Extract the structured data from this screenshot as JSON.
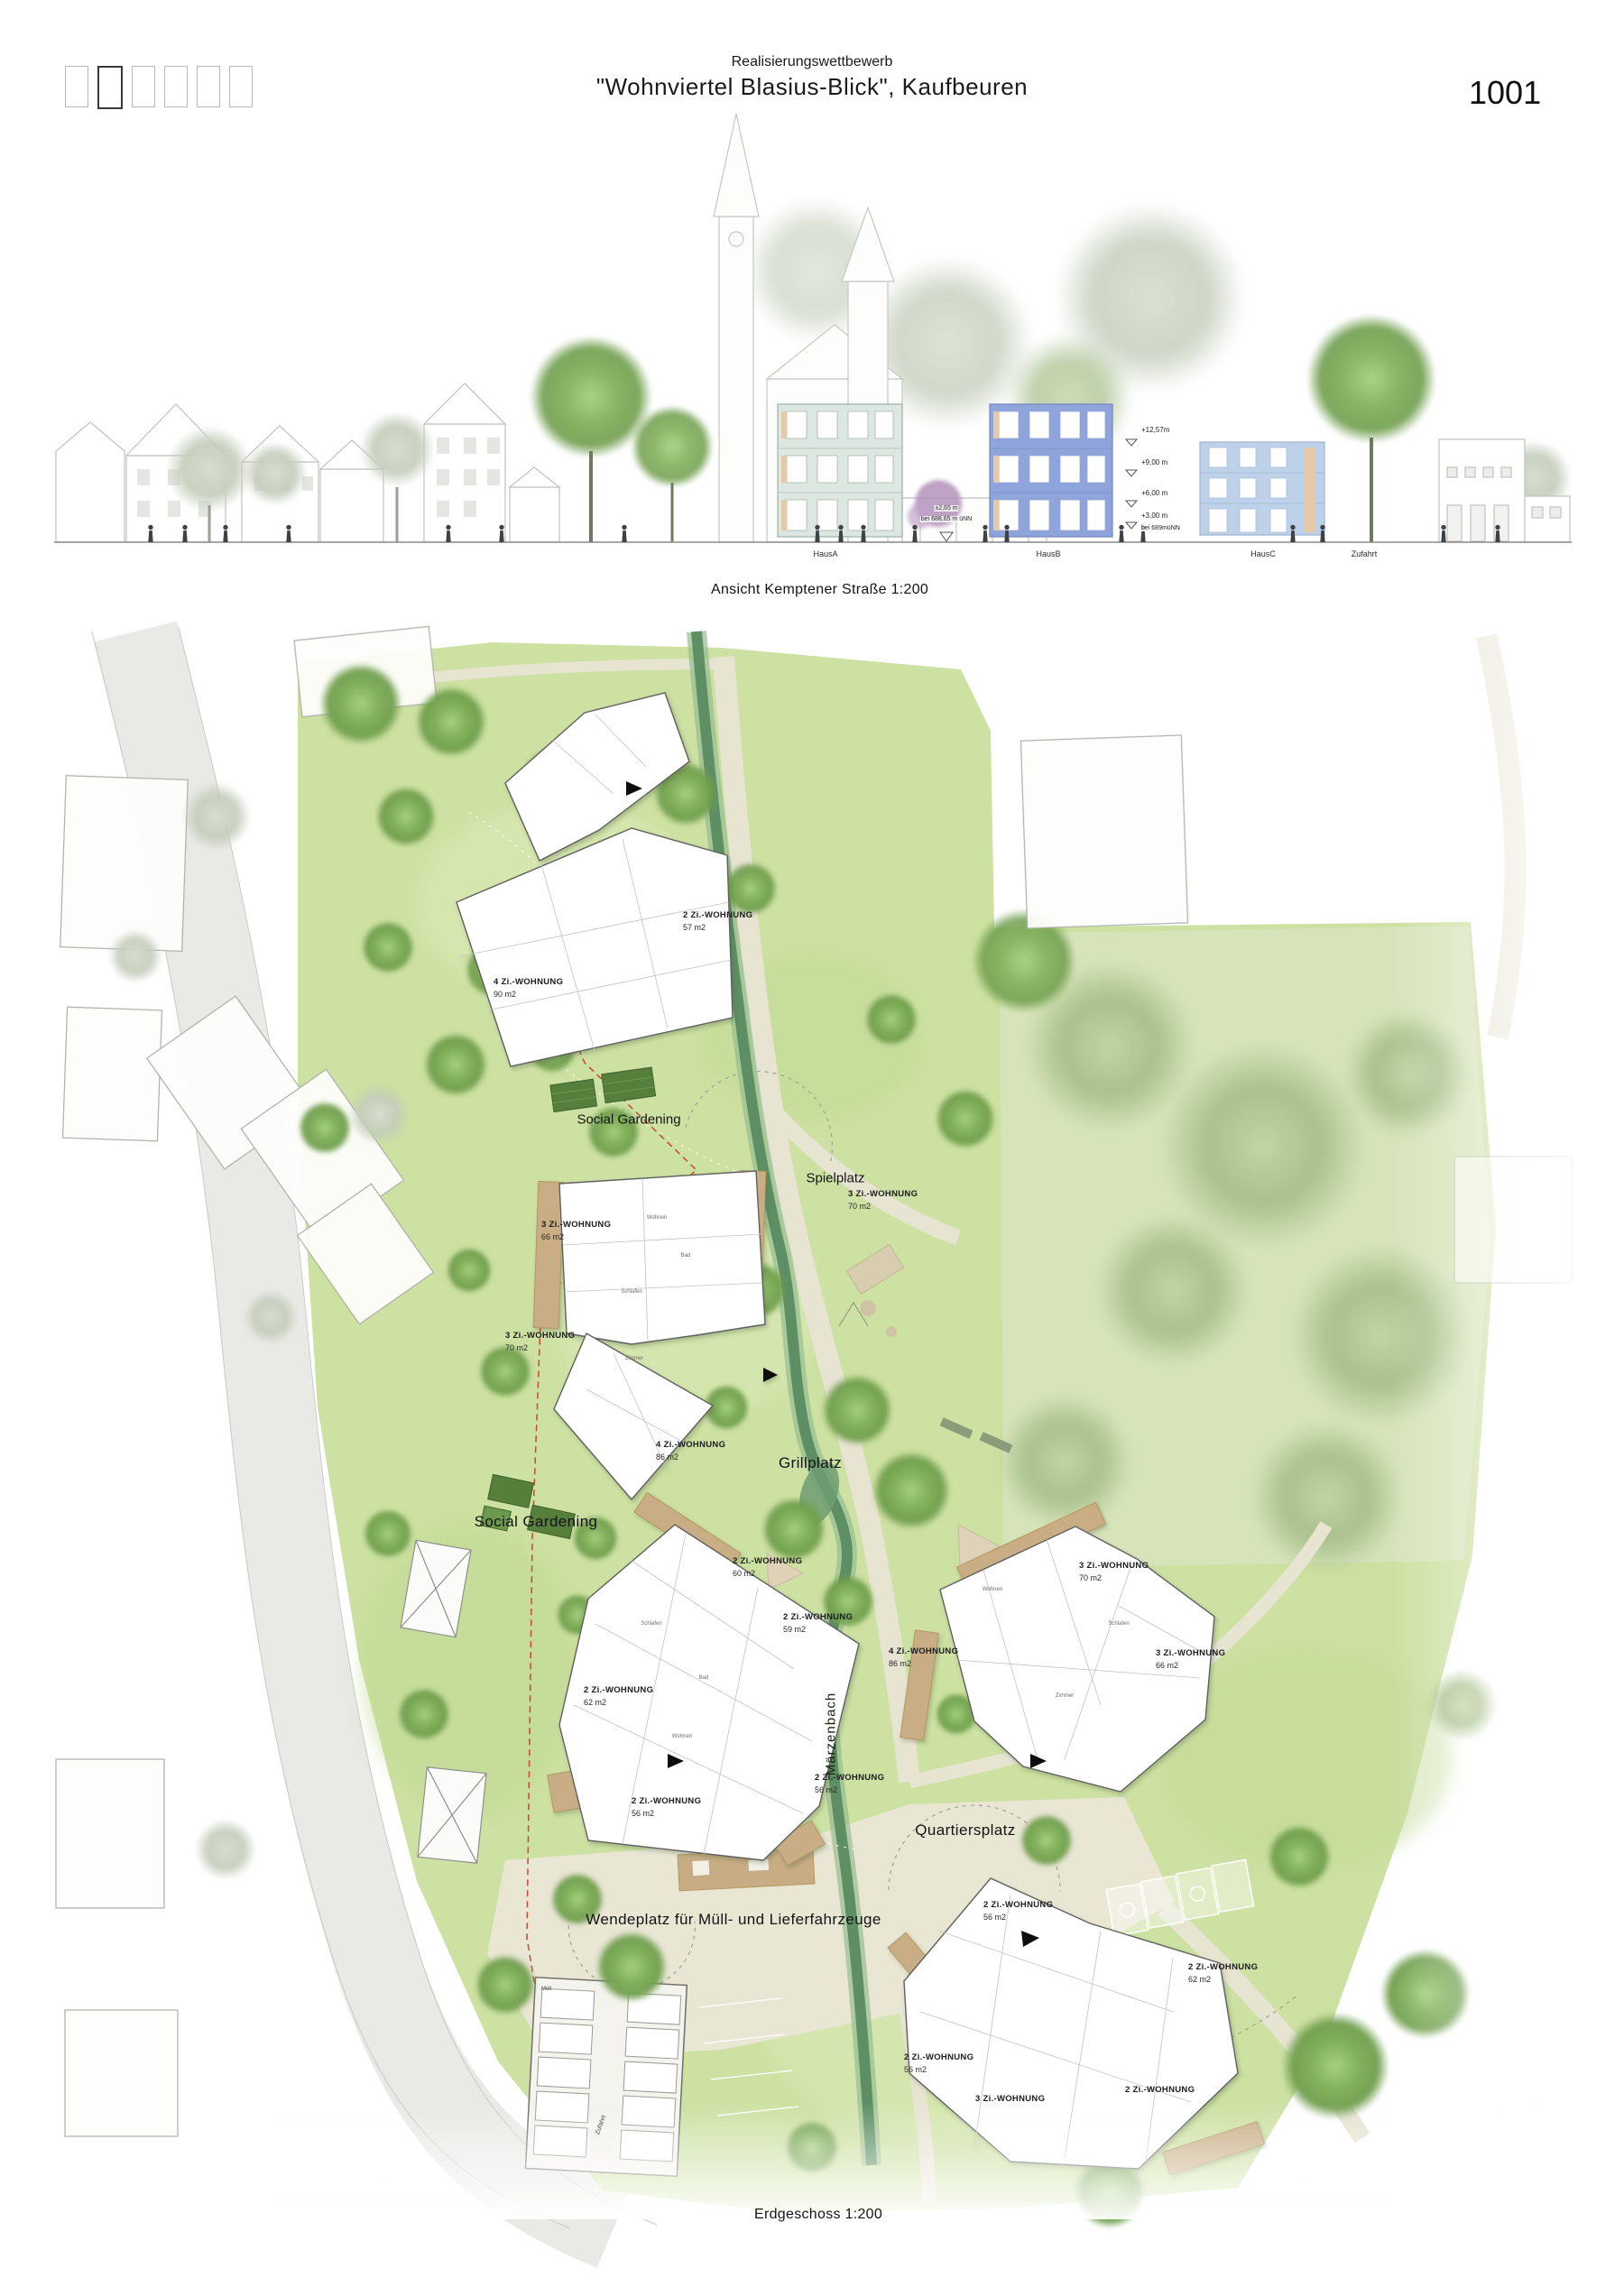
{
  "header": {
    "competition_line": "Realisierungswettbewerb",
    "project_title": "\"Wohnviertel Blasius-Blick\", Kaufbeuren",
    "board_number": "1001"
  },
  "elevation": {
    "caption": "Ansicht Kemptener Straße 1:200",
    "building_labels": [
      {
        "label": "HausA"
      },
      {
        "label": "HausB"
      },
      {
        "label": "HausC"
      },
      {
        "label": "Zufahrt"
      }
    ],
    "left_height_note": {
      "line1": "±2,65 m",
      "line2": "bei 688,65 m üNN"
    },
    "height_marks": [
      {
        "label": "+12,57m"
      },
      {
        "label": "+9,00 m"
      },
      {
        "label": "+6,00 m"
      },
      {
        "label": "+3,00 m"
      },
      {
        "label": "bei 689müNN"
      }
    ]
  },
  "plan": {
    "caption": "Erdgeschoss 1:200",
    "stream_label": "Märzenbach",
    "place_labels": [
      {
        "text": "Social Gardening"
      },
      {
        "text": "Spielplatz"
      },
      {
        "text": "Grillplatz"
      },
      {
        "text": "Social Gardening"
      },
      {
        "text": "Quartiersplatz"
      },
      {
        "text": "Wendeplatz für Müll- und Lieferfahrzeuge"
      }
    ],
    "small_labels": [
      {
        "text": "Zufahrt"
      },
      {
        "text": "Müll"
      }
    ],
    "apartment_labels": [
      {
        "type": "2 Zi.-WOHNUNG",
        "area": "57 m2"
      },
      {
        "type": "4 Zi.-WOHNUNG",
        "area": "90 m2"
      },
      {
        "type": "3 Zi.-WOHNUNG",
        "area": "70 m2"
      },
      {
        "type": "3 Zi.-WOHNUNG",
        "area": "66 m2"
      },
      {
        "type": "3 Zi.-WOHNUNG",
        "area": "70 m2"
      },
      {
        "type": "4 Zi.-WOHNUNG",
        "area": "86 m2"
      },
      {
        "type": "2 Zi.-WOHNUNG",
        "area": "60 m2"
      },
      {
        "type": "2 Zi.-WOHNUNG",
        "area": "59 m2"
      },
      {
        "type": "2 Zi.-WOHNUNG",
        "area": "62 m2"
      },
      {
        "type": "2 Zi.-WOHNUNG",
        "area": "56 m2"
      },
      {
        "type": "2 Zi.-WOHNUNG",
        "area": "56 m2"
      },
      {
        "type": "3 Zi.-WOHNUNG",
        "area": "70 m2"
      },
      {
        "type": "4 Zi.-WOHNUNG",
        "area": "86 m2"
      },
      {
        "type": "3 Zi.-WOHNUNG",
        "area": "66 m2"
      },
      {
        "type": "2 Zi.-WOHNUNG",
        "area": "56 m2"
      },
      {
        "type": "2 Zi.-WOHNUNG",
        "area": "62 m2"
      },
      {
        "type": "2 Zi.-WOHNUNG",
        "area": "56 m2"
      },
      {
        "type": "2 Zi.-WOHNUNG",
        "area": ""
      },
      {
        "type": "3 Zi.-WOHNUNG",
        "area": ""
      }
    ],
    "room_labels": [
      {
        "text": "Wohnen"
      },
      {
        "text": "Schlafen"
      },
      {
        "text": "Zimmer"
      },
      {
        "text": "Bad"
      },
      {
        "text": "Wohnen"
      },
      {
        "text": "Schlafen"
      },
      {
        "text": "Bad"
      },
      {
        "text": "Wohnen"
      },
      {
        "text": "Schlafen"
      },
      {
        "text": "Zimmer"
      }
    ]
  }
}
